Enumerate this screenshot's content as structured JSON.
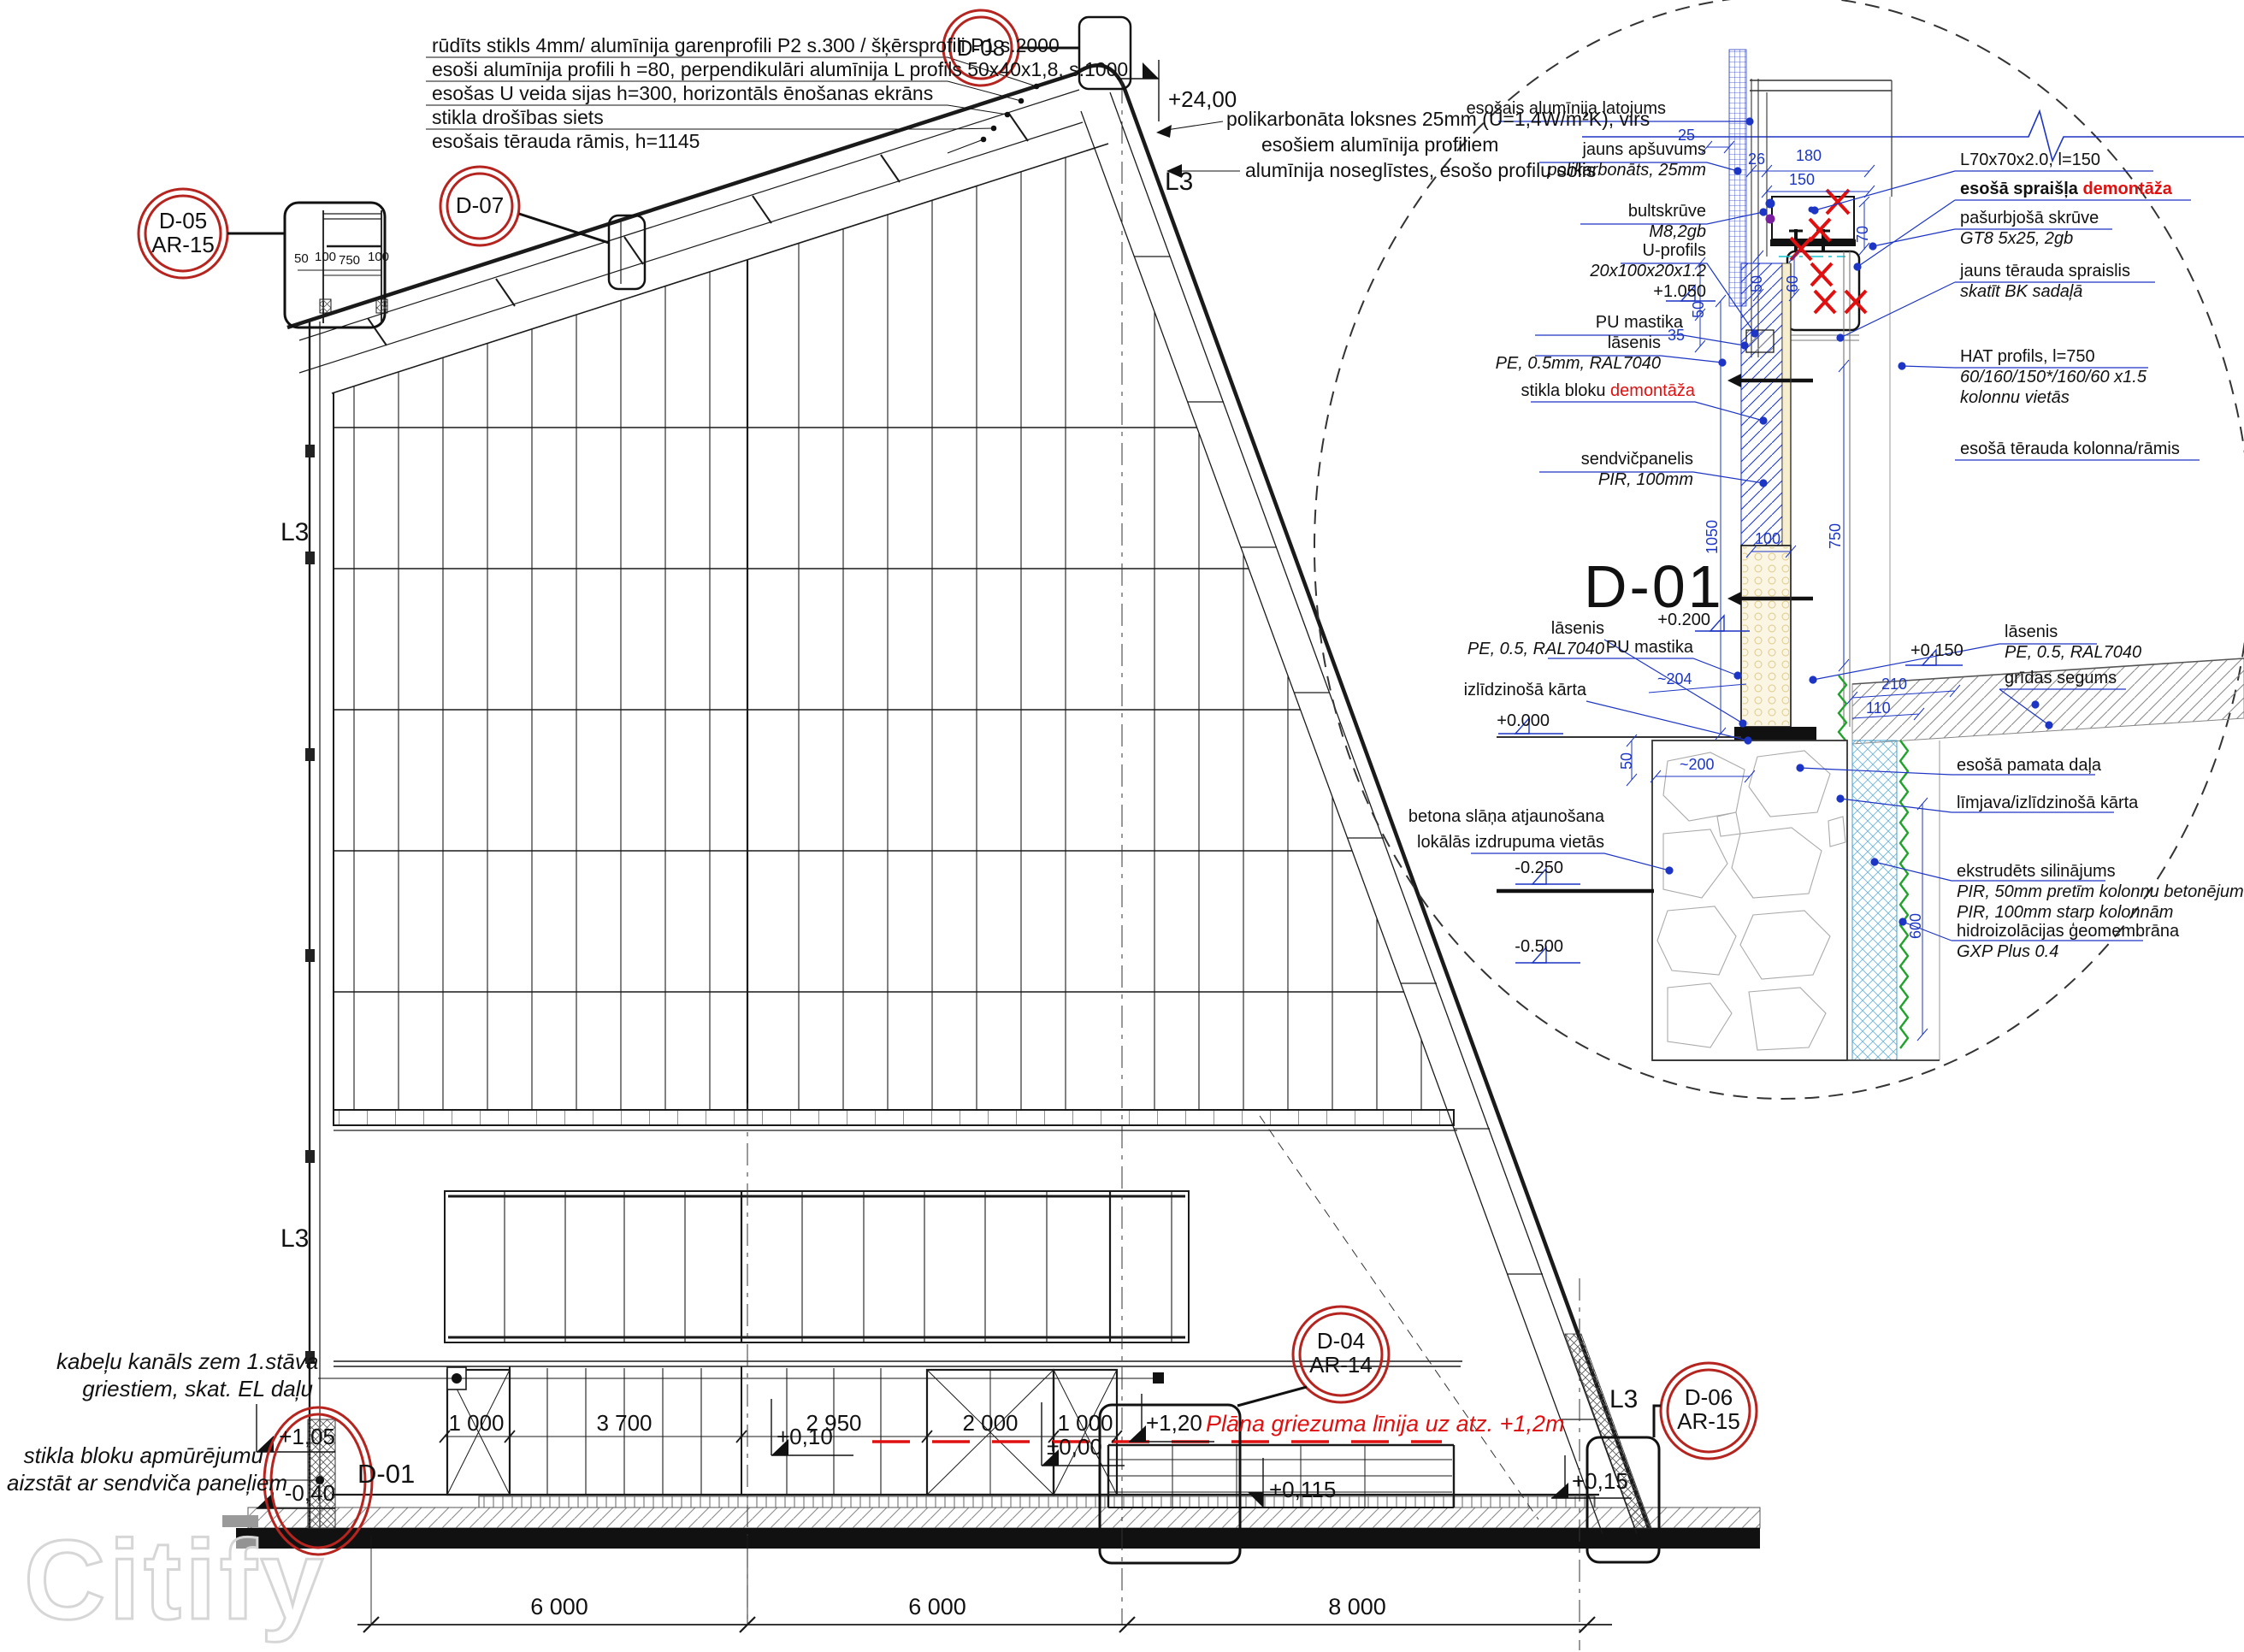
{
  "watermark": "Citify",
  "main": {
    "spec_lines": [
      "rūdīts stikls  4mm/ alumīnija garenprofili P2 s.300 / šķērsprofili P1 s.2000",
      "esoši alumīnija profili h =80, perpendikulāri alumīnija L profils 50x40x1,8, s.1000",
      "esošas U veida sijas h=300, horizontāls ēnošanas ekrāns",
      "stikla drošības siets",
      "esošais tērauda rāmis, h=1145"
    ],
    "roof_note": {
      "l1": "polikarbonāta loksnes 25mm (U=1,4W/m²K), virs",
      "l2": "esošiem alumīnija profiliem",
      "l3": "alumīnija noseglīstes, esošo profilu solis"
    },
    "elev_top": "+24,00",
    "l3": "L3",
    "callouts": {
      "d05": "D-05",
      "d05s": "AR-15",
      "d07": "D-07",
      "d08": "D-08",
      "d04": "D-04",
      "d04s": "AR-14",
      "d06": "D-06",
      "d06s": "AR-15",
      "d01": "D-01"
    },
    "d05_dims": [
      "50",
      "100",
      "750",
      "100"
    ],
    "note_kabelu": [
      "kabeļu kanāls zem 1.stāva",
      "griestiem, skat. EL daļu"
    ],
    "note_stikla": [
      "stikla bloku apmūrējumu",
      "aizstāt ar sendviča paneļiem"
    ],
    "elev": {
      "p105": "+1,05",
      "m040": "-0,40",
      "p010": "+0,10",
      "pm000": "±0,00",
      "p120": "+1,20",
      "p0115": "+0,115",
      "p015": "+0,15"
    },
    "red_note": "Plāna griezuma līnija uz atz. +1,2m",
    "ground_dims": [
      "1 000",
      "3 700",
      "2 950",
      "2 000",
      "1 000"
    ],
    "grid_dims": [
      "6 000",
      "6 000",
      "8 000"
    ]
  },
  "detail": {
    "title": "D-01",
    "latojums": "esošais alumīnija latojums",
    "apsuvums1": "jauns apšuvums",
    "apsuvums2": "polikarbonāts, 25mm",
    "bult1": "bultskrūve",
    "bult2": "M8,2gb",
    "uprof1": "U-profils",
    "uprof2": "20x100x20x1.2",
    "uprof3": "+1.050",
    "pu1": "PU mastika",
    "lasenis1a": "lāsenis",
    "lasenis1b": "PE, 0.5mm, RAL7040",
    "stikla_a": "stikla bloku ",
    "stikla_b": "demontāža",
    "sendvic1": "sendvičpanelis",
    "sendvic2": "PIR, 100mm",
    "pu2": "PU mastika",
    "lasenis2a": "lāsenis",
    "lasenis2b": "PE, 0.5, RAL7040",
    "izlidz": "izlīdzinošā kārta",
    "betona1": "betona slāņa atjaunošana",
    "betona2": "lokālās izdrupuma vietās",
    "L70": "L70x70x2.0, l=150",
    "spraislis_a": "esošā spraišļa ",
    "spraislis_b": "demontāža",
    "pasurb1": "pašurbjošā skrūve",
    "pasurb2": "GT8 5x25, 2gb",
    "jauns1": "jauns tērauda spraislis",
    "jauns2": "skatīt BK sadaļā",
    "hat1": "HAT profils, l=750",
    "hat2": "60/160/150*/160/60 x1.5",
    "hat3": "kolonnu vietās",
    "kolonna": "esošā tērauda kolonna/rāmis",
    "lasenis3a": "lāsenis",
    "lasenis3b": "PE, 0.5, RAL7040",
    "lasenis3c": "grīdas segums",
    "pamata": "esošā pamata daļa",
    "limjava": "līmjava/izlīdzinošā kārta",
    "ekstr1": "ekstrudēts silinājums",
    "ekstr2": "PIR, 50mm pretīm kolonnu betonējumam",
    "ekstr3": "PIR, 100mm starp kolonnām",
    "hidro1": "hidroizolācijas ģeomembrāna",
    "hidro2": "GXP Plus 0.4",
    "elev": {
      "p0200": "+0.200",
      "p0150": "+0.150",
      "p0000": "+0.000",
      "m0250": "-0.250",
      "m0500": "-0.500"
    },
    "dims": {
      "d25": "25",
      "d26": "26",
      "d180": "180",
      "d150": "150",
      "d70": "70",
      "d50a": "50",
      "d60": "60",
      "d50b": "50",
      "d35": "35",
      "d1050": "1050",
      "d100": "100",
      "d750": "750",
      "d204": "~204",
      "d210": "210",
      "d110": "110",
      "d50c": "50",
      "d200": "~200",
      "d600": "600"
    }
  }
}
